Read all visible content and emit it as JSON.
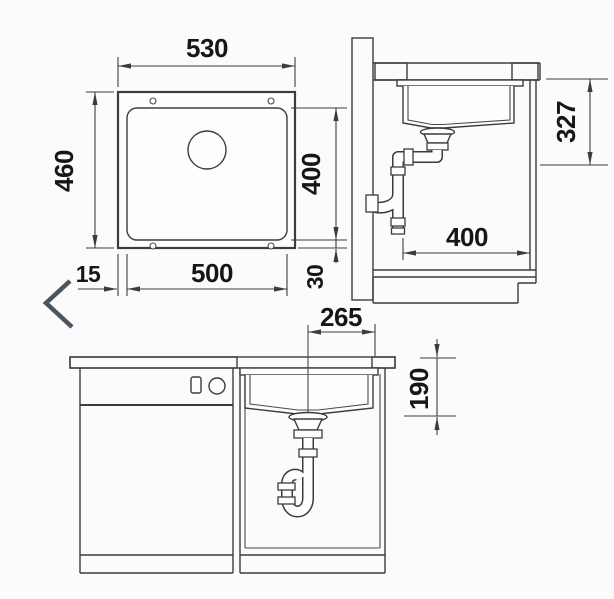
{
  "drawing": {
    "title": "Undermount sink installation drawing",
    "colors": {
      "line": "#3c3c3c",
      "text": "#161616",
      "view_arrow": "#4a5560",
      "background": "#fbfbfb"
    },
    "plan_view": {
      "name": "plan-view",
      "dims": {
        "overall_width": "530",
        "overall_depth": "460",
        "rim_offset": "15",
        "cutout_width": "500",
        "cutout_depth": "400",
        "edge_clearance": "30"
      }
    },
    "section_view": {
      "name": "side-section-view",
      "dims": {
        "drain_height": "327",
        "cabinet_interior_width": "400"
      }
    },
    "front_view": {
      "name": "front-view",
      "dims": {
        "drain_center_offset": "265",
        "bowl_depth": "190"
      }
    }
  }
}
